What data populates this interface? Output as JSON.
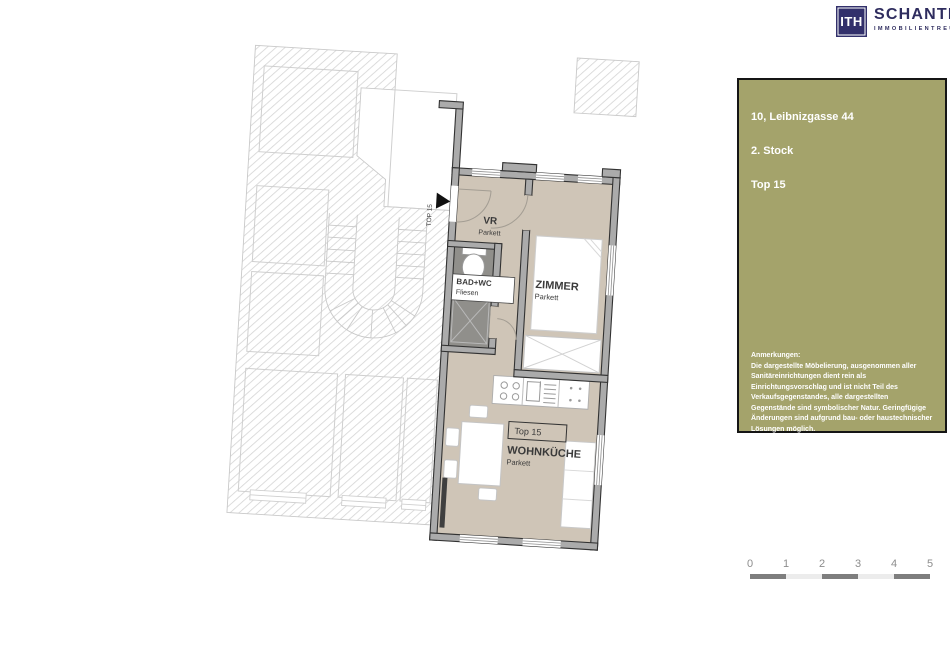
{
  "logo": {
    "mark": "ITH",
    "name": "SCHANTL",
    "subtitle": "IMMOBILIENTREUHAND"
  },
  "info_box": {
    "line1": "10, Leibnizgasse 44",
    "line2": "2. Stock",
    "line3": "Top 15",
    "notes_title": "Anmerkungen:",
    "note1": "Die dargestellte Möbelierung, ausgenommen aller Sanitäreinrichtungen dient rein als Einrichtungsvorschlag und ist nicht Teil des Verkaufsgegenstandes, alle dargestellten Gegenstände sind symbolischer Natur. Geringfügige Änderungen sind aufgrund bau- oder haustechnischer Lösungen möglich.",
    "note2": "Die Flächenangaben sind ungefähre Angaben und können sich in der Detailplanung noch geringfügig ändern.",
    "note3": "Der abgebildete Plan gilt vorbehaltlich bis zur baurechtlichen Genehmigung und kann dabei sich noch entsprechend den baurechtlichen Anforderungen ändern."
  },
  "plan": {
    "entrance_label": "TOP 15",
    "rooms": {
      "vr": {
        "name": "VR",
        "floor": "Parkett"
      },
      "zimmer": {
        "name": "ZIMMER",
        "floor": "Parkett"
      },
      "bad": {
        "name": "BAD+WC",
        "floor": "Fliesen"
      },
      "wohnkueche": {
        "unit": "Top 15",
        "name": "WOHNKÜCHE",
        "floor": "Parkett"
      }
    }
  },
  "scale_bar": {
    "labels": [
      "0",
      "1",
      "2",
      "3",
      "4",
      "5"
    ]
  },
  "colors": {
    "olive": "#a4a36b",
    "navy": "#32306b",
    "floor_beige": "#cfc5b7",
    "bath_gray": "#908f8b",
    "wall_gray": "#ababab",
    "hatch_line": "#d4d4d4"
  }
}
